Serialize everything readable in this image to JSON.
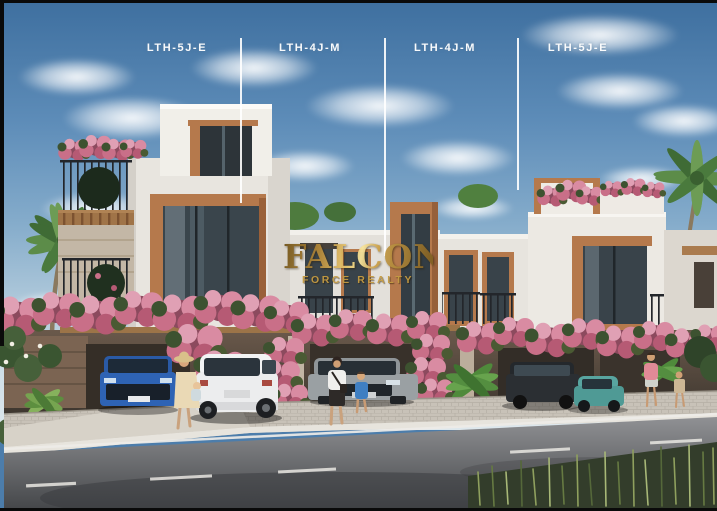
{
  "image": {
    "description": "Exterior render of a modern townhouse row with watermark"
  },
  "unit_labels": [
    {
      "label": "LTH-5J-E"
    },
    {
      "label": "LTH-4J-M"
    },
    {
      "label": "LTH-4J-M"
    },
    {
      "label": "LTH-5J-E"
    }
  ],
  "watermark": {
    "brand": "FALCON",
    "tagline": "FORCE REALTY"
  },
  "colors": {
    "sky_top": "#3e6f9f",
    "sky_horizon": "#dde7ec",
    "label_text": "#ffffff",
    "gold": "#c49b42",
    "facade": "#eae7e1",
    "wood_trim": "#b5794c",
    "bougainvillea": "#c96f88",
    "road": "#55575a"
  }
}
